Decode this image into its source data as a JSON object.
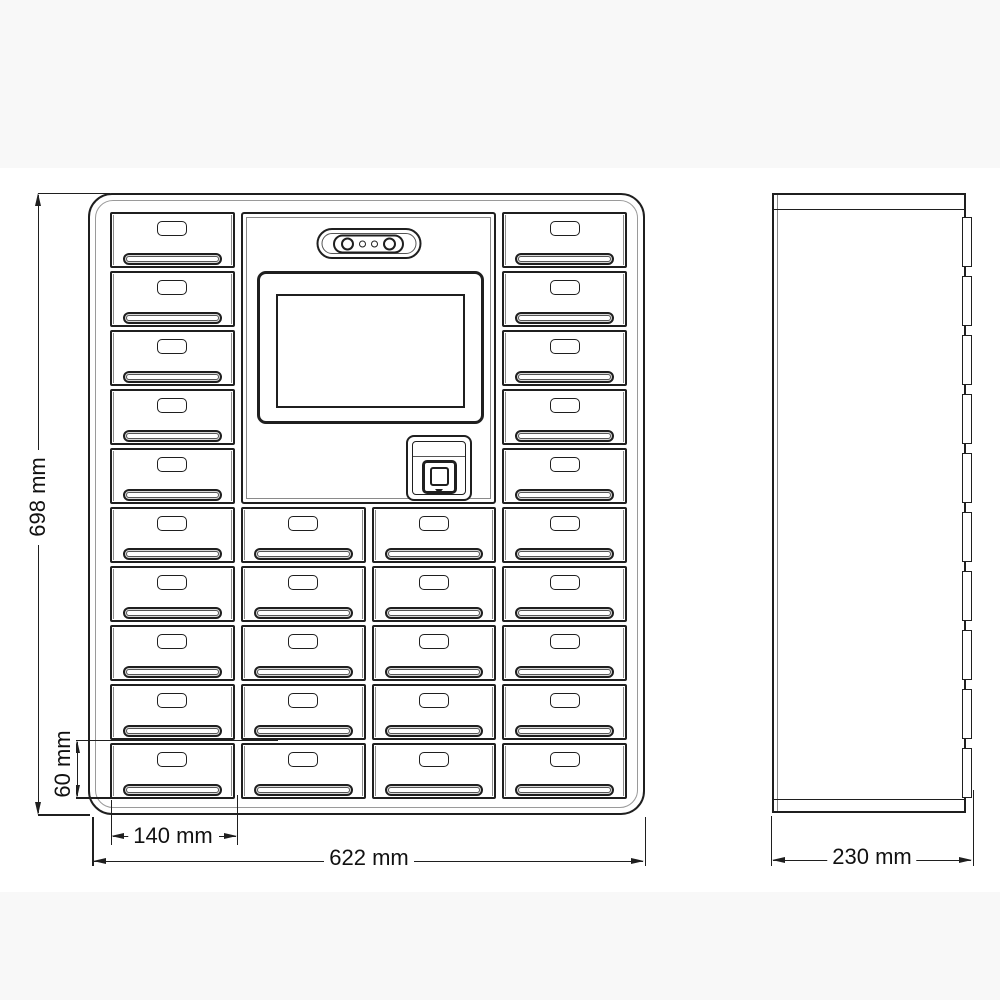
{
  "drawing_type": "key-locker-cabinet-technical-drawing",
  "colors": {
    "line": "#1f1f1f",
    "soft_line": "#8a8a8a",
    "background": "#ffffff",
    "band": "#f8f8f8",
    "lip_shade": "#d9d9d9"
  },
  "front_view": {
    "rows": 10,
    "cols": 4,
    "compartments_total": 30,
    "panel": {
      "col_start": 1,
      "col_end": 2,
      "row_span": 5
    },
    "indicator_leds": [
      "led-large",
      "led-small",
      "led-small",
      "led-large"
    ]
  },
  "side_view": {
    "door_edges": 10
  },
  "dimensions": {
    "height_label": "698 mm",
    "width_label": "622 mm",
    "depth_label": "230 mm",
    "cell_width_label": "140 mm",
    "cell_height_label": "60 mm"
  }
}
